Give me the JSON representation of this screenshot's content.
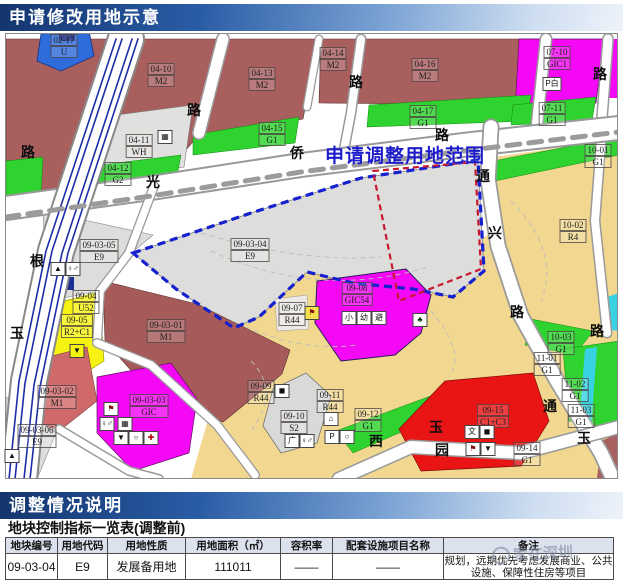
{
  "header": {
    "title": "申请修改用地示意"
  },
  "section2": {
    "title": "调整情况说明"
  },
  "map": {
    "range_label": "申请调整用地范围",
    "colors": {
      "industrial_m2": "#aa5f5f",
      "industrial_m1_light": "#d06a6a",
      "reserve_gray": "#dddddb",
      "residential_sandy": "#f1d78f",
      "gic_magenta": "#f508f5",
      "green_g1": "#2fd32f",
      "utility_blue": "#2f6cdb",
      "commercial_red": "#e91515",
      "bright_yellow_r2c1": "#f6f312",
      "cyan_canal": "#38d2e2",
      "boundary_blue_dash": "#1520cf",
      "boundary_red_dash": "#c81830"
    },
    "parcel_labels": [
      {
        "lines": [
          "02-17",
          "U"
        ],
        "x": 63,
        "y": 33
      },
      {
        "lines": [
          "04-10",
          "M2"
        ],
        "x": 160,
        "y": 62
      },
      {
        "lines": [
          "04-13",
          "M2"
        ],
        "x": 261,
        "y": 66
      },
      {
        "lines": [
          "04-14",
          "M2"
        ],
        "x": 332,
        "y": 46
      },
      {
        "lines": [
          "04-16",
          "M2"
        ],
        "x": 424,
        "y": 57
      },
      {
        "lines": [
          "04-17",
          "G1"
        ],
        "x": 422,
        "y": 104
      },
      {
        "lines": [
          "04-15",
          "G1"
        ],
        "x": 271,
        "y": 121
      },
      {
        "lines": [
          "04-11",
          "WH"
        ],
        "x": 138,
        "y": 133
      },
      {
        "lines": [
          "04-12",
          "G2"
        ],
        "x": 117,
        "y": 161
      },
      {
        "lines": [
          "07-10",
          "GIC1"
        ],
        "x": 556,
        "y": 45
      },
      {
        "lines": [
          "07-11",
          "G1"
        ],
        "x": 551,
        "y": 101
      },
      {
        "lines": [
          "10-01",
          "G1"
        ],
        "x": 597,
        "y": 143
      },
      {
        "lines": [
          "10-02",
          "R4"
        ],
        "x": 572,
        "y": 218
      },
      {
        "lines": [
          "09-03-05",
          "E9"
        ],
        "x": 98,
        "y": 238
      },
      {
        "lines": [
          "09-03-04",
          "E9"
        ],
        "x": 249,
        "y": 237
      },
      {
        "lines": [
          "09-04",
          "U52"
        ],
        "x": 85,
        "y": 289
      },
      {
        "lines": [
          "09-05",
          "R2+C1"
        ],
        "x": 76,
        "y": 313
      },
      {
        "lines": [
          "09-03-01",
          "M1"
        ],
        "x": 165,
        "y": 318
      },
      {
        "lines": [
          "09-03-02",
          "M1"
        ],
        "x": 56,
        "y": 384
      },
      {
        "lines": [
          "09-03-06",
          "E9"
        ],
        "x": 36,
        "y": 423
      },
      {
        "lines": [
          "09-03-03",
          "GIC"
        ],
        "x": 148,
        "y": 393
      },
      {
        "lines": [
          "09-07",
          "R44"
        ],
        "x": 291,
        "y": 301
      },
      {
        "lines": [
          "09-08",
          "GIC54"
        ],
        "x": 356,
        "y": 281
      },
      {
        "lines": [
          "09-09",
          "R44"
        ],
        "x": 260,
        "y": 379
      },
      {
        "lines": [
          "09-10",
          "S2"
        ],
        "x": 293,
        "y": 409
      },
      {
        "lines": [
          "09-11",
          "R44"
        ],
        "x": 329,
        "y": 388
      },
      {
        "lines": [
          "09-12",
          "G1"
        ],
        "x": 367,
        "y": 407
      },
      {
        "lines": [
          "09-15",
          "C1+C3"
        ],
        "x": 492,
        "y": 403
      },
      {
        "lines": [
          "11-01",
          "G1"
        ],
        "x": 546,
        "y": 351
      },
      {
        "lines": [
          "11-02",
          "G1"
        ],
        "x": 574,
        "y": 377
      },
      {
        "lines": [
          "11-03",
          "G1"
        ],
        "x": 580,
        "y": 403
      },
      {
        "lines": [
          "09-14",
          "G1"
        ],
        "x": 526,
        "y": 441
      },
      {
        "lines": [
          "10-03",
          "G1"
        ],
        "x": 560,
        "y": 330
      }
    ],
    "road_chars": [
      {
        "ch": "路",
        "x": 193,
        "y": 104
      },
      {
        "ch": "路",
        "x": 27,
        "y": 146
      },
      {
        "ch": "光",
        "x": 152,
        "y": 176
      },
      {
        "ch": "侨",
        "x": 296,
        "y": 147
      },
      {
        "ch": "路",
        "x": 441,
        "y": 129
      },
      {
        "ch": "根",
        "x": 36,
        "y": 255
      },
      {
        "ch": "玉",
        "x": 16,
        "y": 327
      },
      {
        "ch": "路",
        "x": 355,
        "y": 76
      },
      {
        "ch": "路",
        "x": 599,
        "y": 68
      },
      {
        "ch": "通",
        "x": 482,
        "y": 170
      },
      {
        "ch": "兴",
        "x": 494,
        "y": 227
      },
      {
        "ch": "路",
        "x": 516,
        "y": 306
      },
      {
        "ch": "路",
        "x": 596,
        "y": 325
      },
      {
        "ch": "西",
        "x": 375,
        "y": 435
      },
      {
        "ch": "玉",
        "x": 435,
        "y": 421
      },
      {
        "ch": "园",
        "x": 441,
        "y": 444
      },
      {
        "ch": "通",
        "x": 549,
        "y": 400
      },
      {
        "ch": "玉",
        "x": 583,
        "y": 432
      }
    ],
    "facility_icons": [
      {
        "name": "warehouse-icon",
        "g": "▦",
        "x": 164,
        "y": 129
      },
      {
        "name": "parking-white-icon",
        "g": "P白",
        "x": 551,
        "y": 76,
        "w": 17
      },
      {
        "name": "toilet-icon",
        "g": "♀♂",
        "x": 72,
        "y": 261
      },
      {
        "name": "pump-icon",
        "g": "▲",
        "x": 57,
        "y": 261
      },
      {
        "name": "market-icon",
        "g": "▼",
        "x": 76,
        "y": 343,
        "bg": "#f6f312"
      },
      {
        "name": "kindergarten-icon",
        "g": "⚑",
        "x": 311,
        "y": 305,
        "bg": "#f5df4e",
        "fg": "#8a1010"
      },
      {
        "name": "tree-icon",
        "g": "♣",
        "x": 419,
        "y": 312,
        "fg": "#0a3a0a"
      },
      {
        "name": "primary-school-box",
        "g": "小",
        "x": 348,
        "y": 310
      },
      {
        "name": "kindergarten-box",
        "g": "幼",
        "x": 363,
        "y": 310
      },
      {
        "name": "shelter-box",
        "g": "避",
        "x": 378,
        "y": 310
      },
      {
        "name": "school-icon",
        "g": "⚑",
        "x": 110,
        "y": 401,
        "fg": "#8a1010"
      },
      {
        "name": "toilet-icon",
        "g": "♀♂",
        "x": 106,
        "y": 416
      },
      {
        "name": "bus-icon",
        "g": "▦",
        "x": 124,
        "y": 416
      },
      {
        "name": "market-icon",
        "g": "▼",
        "x": 120,
        "y": 430
      },
      {
        "name": "gas-icon",
        "g": "○",
        "x": 135,
        "y": 430
      },
      {
        "name": "hospital-icon",
        "g": "✚",
        "x": 150,
        "y": 430,
        "fg": "#b00000"
      },
      {
        "name": "substation-icon",
        "g": "◼",
        "x": 281,
        "y": 383
      },
      {
        "name": "plaza-box",
        "g": "广",
        "x": 291,
        "y": 433
      },
      {
        "name": "toilet-icon",
        "g": "♀♂",
        "x": 306,
        "y": 433
      },
      {
        "name": "house-icon",
        "g": "⌂",
        "x": 330,
        "y": 411
      },
      {
        "name": "parking-icon",
        "g": "P",
        "x": 331,
        "y": 429
      },
      {
        "name": "circle-icon",
        "g": "○",
        "x": 346,
        "y": 429
      },
      {
        "name": "culture-box",
        "g": "文",
        "x": 471,
        "y": 424
      },
      {
        "name": "block-icon",
        "g": "◼",
        "x": 486,
        "y": 424
      },
      {
        "name": "school-icon",
        "g": "⚑",
        "x": 472,
        "y": 441,
        "fg": "#8a1010"
      },
      {
        "name": "market-icon",
        "g": "▼",
        "x": 487,
        "y": 441
      },
      {
        "name": "monument-icon",
        "g": "▲",
        "x": 11,
        "y": 448
      }
    ]
  },
  "table": {
    "title": "地块控制指标一览表(调整前)",
    "headers": [
      "地块编号",
      "用地代码",
      "用地性质",
      "用地面积（㎡）",
      "容积率",
      "配套设施项目名称",
      "备注"
    ],
    "row": {
      "plot_no": "09-03-04",
      "code": "E9",
      "nature": "发展备用地",
      "area": "111011",
      "far": "——",
      "facilities": "——",
      "remark": "规划，远期优先考虑发展商业、公共设施、保障性住房等项目"
    }
  },
  "watermark": {
    "text": "家在深圳"
  }
}
